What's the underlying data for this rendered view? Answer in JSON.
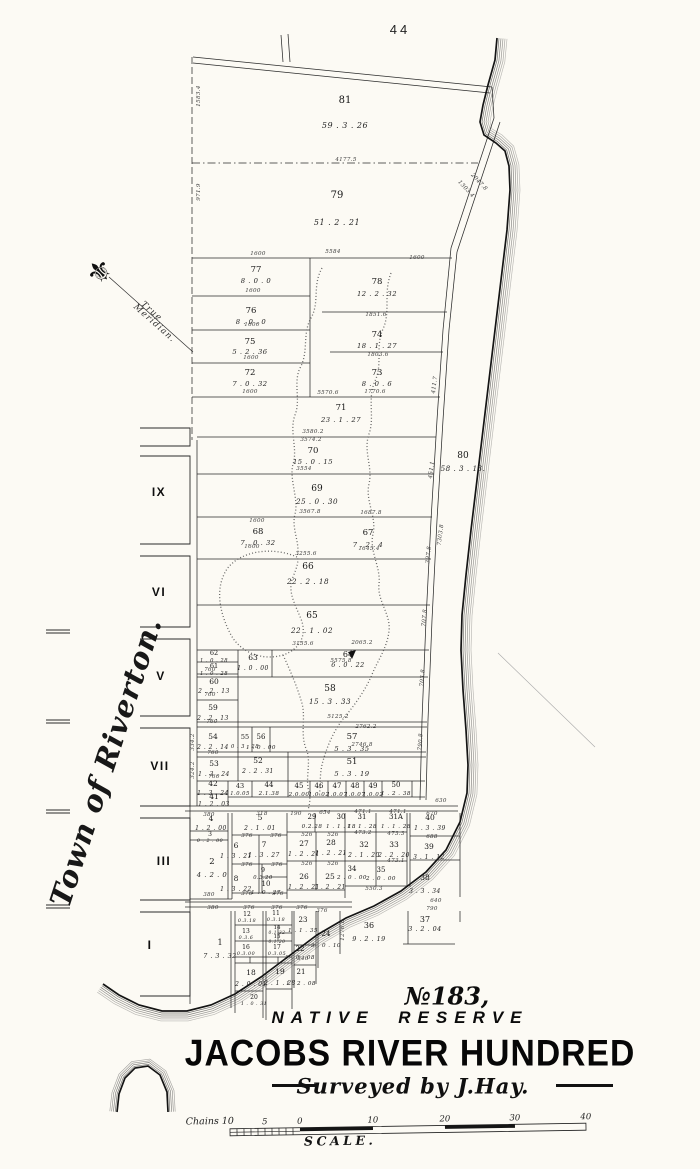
{
  "page": {
    "sheet_number": "44"
  },
  "map": {
    "side_label": "Town of Riverton.",
    "compass_icon": "⚜",
    "compass_label_line1": "True",
    "compass_label_line2": "Meridian.",
    "blocks": [
      {
        "numeral": "IX",
        "x": 159,
        "y": 496
      },
      {
        "numeral": "VI",
        "x": 159,
        "y": 596
      },
      {
        "numeral": "V",
        "x": 161,
        "y": 680
      },
      {
        "numeral": "VII",
        "x": 160,
        "y": 770
      },
      {
        "numeral": "III",
        "x": 164,
        "y": 865
      },
      {
        "numeral": "I",
        "x": 150,
        "y": 949
      }
    ],
    "lots": [
      {
        "n": "81",
        "a": "59 . 3 . 26",
        "x": 345,
        "y": 103,
        "fs": 10,
        "dy": 25
      },
      {
        "n": "79",
        "a": "51 . 2 . 21",
        "x": 337,
        "y": 198,
        "fs": 10,
        "dy": 27
      },
      {
        "n": "77",
        "a": "8 . 0 . 0",
        "x": 256,
        "y": 272,
        "fs": 8.5,
        "dy": 11
      },
      {
        "n": "78",
        "a": "12 . 2 . 32",
        "x": 377,
        "y": 284,
        "fs": 8.5,
        "dy": 12
      },
      {
        "n": "76",
        "a": "8 . 0 . 0",
        "x": 251,
        "y": 313,
        "fs": 8.5,
        "dy": 11
      },
      {
        "n": "74",
        "a": "18 . 1 . 27",
        "x": 377,
        "y": 337,
        "fs": 8.5,
        "dy": 11
      },
      {
        "n": "75",
        "a": "5 . 2 . 36",
        "x": 250,
        "y": 344,
        "fs": 8.5,
        "dy": 10
      },
      {
        "n": "72",
        "a": "7 . 0 . 32",
        "x": 250,
        "y": 375,
        "fs": 8.5,
        "dy": 11
      },
      {
        "n": "73",
        "a": "8 . 0 . 6",
        "x": 377,
        "y": 375,
        "fs": 8.5,
        "dy": 11
      },
      {
        "n": "71",
        "a": "23 . 1 . 27",
        "x": 341,
        "y": 410,
        "fs": 8.5,
        "dy": 12
      },
      {
        "n": "70",
        "a": "15 . 0 . 15",
        "x": 313,
        "y": 453,
        "fs": 8.5,
        "dy": 11
      },
      {
        "n": "69",
        "a": "25 . 0 . 30",
        "x": 317,
        "y": 491,
        "fs": 9,
        "dy": 13
      },
      {
        "n": "80",
        "a": "58 . 3 . 13.",
        "x": 463,
        "y": 458,
        "fs": 9,
        "dy": 13
      },
      {
        "n": "68",
        "a": "7 . 0 . 32",
        "x": 258,
        "y": 534,
        "fs": 8.5,
        "dy": 11
      },
      {
        "n": "67",
        "a": "7 . 2 . 4",
        "x": 368,
        "y": 535,
        "fs": 8.5,
        "dy": 12
      },
      {
        "n": "66",
        "a": "22 . 2 . 18",
        "x": 308,
        "y": 569,
        "fs": 9,
        "dy": 15
      },
      {
        "n": "65",
        "a": "22 . 1 . 02",
        "x": 312,
        "y": 618,
        "fs": 9,
        "dy": 15
      },
      {
        "n": "63",
        "a": "1 . 0 . 00",
        "x": 253,
        "y": 660,
        "fs": 7.5,
        "dy": 10
      },
      {
        "n": "64",
        "a": "6 . 0 . 22",
        "x": 348,
        "y": 657,
        "fs": 8,
        "dy": 10
      },
      {
        "n": "62",
        "a": "1 . 0 . 28",
        "x": 214,
        "y": 655,
        "fs": 6.5,
        "dy": 7
      },
      {
        "n": "61",
        "a": "1 . 0 . 28",
        "x": 214,
        "y": 668,
        "fs": 6.5,
        "dy": 7
      },
      {
        "n": "60",
        "a": "2 . 2 . 13",
        "x": 214,
        "y": 684,
        "fs": 7.5,
        "dy": 9
      },
      {
        "n": "58",
        "a": "15 . 3 . 33",
        "x": 330,
        "y": 691,
        "fs": 9,
        "dy": 13
      },
      {
        "n": "59",
        "a": "2 . 2 . 13",
        "x": 213,
        "y": 710,
        "fs": 7.5,
        "dy": 10
      },
      {
        "n": "54",
        "a": "2 . 2 . 14",
        "x": 213,
        "y": 739,
        "fs": 7.5,
        "dy": 10
      },
      {
        "n": "55",
        "a": "0 . 3 . 28",
        "x": 245,
        "y": 739,
        "fs": 6.5,
        "dy": 9
      },
      {
        "n": "56",
        "a": "1 . 0 . 00",
        "x": 261,
        "y": 739,
        "fs": 7,
        "dy": 10
      },
      {
        "n": "57",
        "a": "5 . 3 . 35",
        "x": 352,
        "y": 739,
        "fs": 8.5,
        "dy": 12
      },
      {
        "n": "53",
        "a": "1 . 3 . 24",
        "x": 214,
        "y": 766,
        "fs": 7.5,
        "dy": 10
      },
      {
        "n": "52",
        "a": "2 . 2 . 31",
        "x": 258,
        "y": 763,
        "fs": 7.5,
        "dy": 10
      },
      {
        "n": "51",
        "a": "5 . 3 . 19",
        "x": 352,
        "y": 764,
        "fs": 8.5,
        "dy": 12
      },
      {
        "n": "42",
        "a": "1 . 3 . 24",
        "x": 213,
        "y": 786,
        "fs": 7.5,
        "dy": 9
      },
      {
        "n": "41",
        "a": "1 . 2 . 03",
        "x": 214,
        "y": 799,
        "fs": 7.5,
        "dy": 7
      },
      {
        "n": "43",
        "a": "1.0.05",
        "x": 240,
        "y": 788,
        "fs": 6.5,
        "dy": 7
      },
      {
        "n": "44",
        "a": "2.1.38",
        "x": 269,
        "y": 787,
        "fs": 7,
        "dy": 8
      },
      {
        "n": "45",
        "a": "2.0.00",
        "x": 299,
        "y": 788,
        "fs": 7,
        "dy": 8
      },
      {
        "n": "46",
        "a": "1.0.02",
        "x": 319,
        "y": 788,
        "fs": 7,
        "dy": 8
      },
      {
        "n": "47",
        "a": "1.0.07",
        "x": 337,
        "y": 788,
        "fs": 7,
        "dy": 8
      },
      {
        "n": "48",
        "a": "1.0.07",
        "x": 355,
        "y": 788,
        "fs": 7,
        "dy": 8
      },
      {
        "n": "49",
        "a": "1.0.02",
        "x": 373,
        "y": 788,
        "fs": 7,
        "dy": 8
      },
      {
        "n": "50",
        "a": "1 . 2 . 38",
        "x": 396,
        "y": 787,
        "fs": 7,
        "dy": 8
      },
      {
        "n": "4",
        "a": "1 . 2 . 00",
        "x": 211,
        "y": 821,
        "fs": 7.5,
        "dy": 9
      },
      {
        "n": "3",
        "a": "0 . 2 . 00",
        "x": 210,
        "y": 836,
        "fs": 6,
        "dy": 6
      },
      {
        "n": "2",
        "a": "4 . 2 . 0",
        "x": 212,
        "y": 864,
        "fs": 8.5,
        "dy": 13
      },
      {
        "n": "5",
        "a": "2 . 1 . 01",
        "x": 260,
        "y": 820,
        "fs": 7.5,
        "dy": 10
      },
      {
        "n": "29",
        "a": "0.2.28",
        "x": 312,
        "y": 819,
        "fs": 7,
        "dy": 9
      },
      {
        "n": "30",
        "a": "1 . 1 . 18",
        "x": 341,
        "y": 819,
        "fs": 7,
        "dy": 9
      },
      {
        "n": "31",
        "a": "1 . 1 . 28",
        "x": 362,
        "y": 819,
        "fs": 7,
        "dy": 9
      },
      {
        "n": "31A",
        "a": "1 . 1 . 28",
        "x": 396,
        "y": 819,
        "fs": 7,
        "dy": 9
      },
      {
        "n": "40",
        "a": "1 . 3 . 39",
        "x": 430,
        "y": 820,
        "fs": 7.5,
        "dy": 10
      },
      {
        "n": "6",
        "a": "1 . 3 . 21",
        "x": 236,
        "y": 848,
        "fs": 7.5,
        "dy": 10
      },
      {
        "n": "7",
        "a": "1 . 3 . 27",
        "x": 264,
        "y": 847,
        "fs": 7.5,
        "dy": 10
      },
      {
        "n": "27",
        "a": "1 . 2 . 21",
        "x": 304,
        "y": 846,
        "fs": 7.5,
        "dy": 10
      },
      {
        "n": "28",
        "a": "1 . 2 . 21",
        "x": 331,
        "y": 845,
        "fs": 7.5,
        "dy": 10
      },
      {
        "n": "32",
        "a": "2 . 1 . 20",
        "x": 364,
        "y": 847,
        "fs": 7.5,
        "dy": 10
      },
      {
        "n": "33",
        "a": "2 . 2 . 20",
        "x": 394,
        "y": 847,
        "fs": 7.5,
        "dy": 10
      },
      {
        "n": "39",
        "a": "3 . 1 . 12",
        "x": 429,
        "y": 849,
        "fs": 7.5,
        "dy": 10
      },
      {
        "n": "8",
        "a": "1 . 3 . 22",
        "x": 236,
        "y": 881,
        "fs": 7.5,
        "dy": 10
      },
      {
        "n": "9",
        "a": "0.3.20",
        "x": 263,
        "y": 872,
        "fs": 6.5,
        "dy": 7
      },
      {
        "n": "10",
        "a": "1 . 0 . 27",
        "x": 266,
        "y": 886,
        "fs": 7,
        "dy": 8
      },
      {
        "n": "26",
        "a": "1 . 2 . 21",
        "x": 304,
        "y": 879,
        "fs": 7.5,
        "dy": 10
      },
      {
        "n": "25",
        "a": "1 . 2 . 21",
        "x": 330,
        "y": 879,
        "fs": 7.5,
        "dy": 10
      },
      {
        "n": "34",
        "a": "2 . 0 . 00",
        "x": 352,
        "y": 871,
        "fs": 7,
        "dy": 8
      },
      {
        "n": "35",
        "a": "2 . 0 . 00",
        "x": 381,
        "y": 872,
        "fs": 7,
        "dy": 8
      },
      {
        "n": "38",
        "a": "3 . 3 . 34",
        "x": 425,
        "y": 880,
        "fs": 7.5,
        "dy": 13
      },
      {
        "n": "1",
        "a": "7 . 3 . 32",
        "x": 220,
        "y": 945,
        "fs": 8,
        "dy": 13
      },
      {
        "n": "12",
        "a": "0.3.18",
        "x": 247,
        "y": 916,
        "fs": 6,
        "dy": 6
      },
      {
        "n": "11",
        "a": "0.3.18",
        "x": 276,
        "y": 915,
        "fs": 6,
        "dy": 6
      },
      {
        "n": "13",
        "a": "0.3.6",
        "x": 246,
        "y": 933,
        "fs": 6,
        "dy": 6
      },
      {
        "n": "14",
        "a": "0.1.32",
        "x": 277,
        "y": 929,
        "fs": 5.5,
        "dy": 5
      },
      {
        "n": "15",
        "a": "0.1.20",
        "x": 277,
        "y": 938,
        "fs": 5.5,
        "dy": 5
      },
      {
        "n": "16",
        "a": "0.3.00",
        "x": 246,
        "y": 949,
        "fs": 6,
        "dy": 6
      },
      {
        "n": "17",
        "a": "0.3.05",
        "x": 277,
        "y": 949,
        "fs": 6,
        "dy": 6
      },
      {
        "n": "23",
        "a": "1 . 1 . 35",
        "x": 303,
        "y": 922,
        "fs": 7,
        "dy": 10
      },
      {
        "n": "22",
        "a": "1 . 0 . 08",
        "x": 300,
        "y": 951,
        "fs": 7,
        "dy": 8
      },
      {
        "n": "24",
        "a": "3 . 0 . 10",
        "x": 326,
        "y": 936,
        "fs": 7,
        "dy": 11
      },
      {
        "n": "36",
        "a": "9 . 2 . 19",
        "x": 369,
        "y": 928,
        "fs": 8,
        "dy": 13
      },
      {
        "n": "37",
        "a": "3 . 2 . 04",
        "x": 425,
        "y": 922,
        "fs": 8,
        "dy": 9
      },
      {
        "n": "18",
        "a": "2 . 0 . 01",
        "x": 251,
        "y": 975,
        "fs": 7.5,
        "dy": 11
      },
      {
        "n": "19",
        "a": "2 . 1 . 28",
        "x": 280,
        "y": 974,
        "fs": 7.5,
        "dy": 11
      },
      {
        "n": "21",
        "a": "1 . 2 . 08",
        "x": 301,
        "y": 974,
        "fs": 7,
        "dy": 11
      },
      {
        "n": "20",
        "a": "1 . 0 . 31",
        "x": 254,
        "y": 999,
        "fs": 6,
        "dy": 6
      }
    ],
    "edge_labels": [
      {
        "t": "4177.5",
        "x": 346,
        "y": 161
      },
      {
        "t": "1600",
        "x": 258,
        "y": 255
      },
      {
        "t": "5584",
        "x": 333,
        "y": 253
      },
      {
        "t": "1600",
        "x": 417,
        "y": 259
      },
      {
        "t": "1600",
        "x": 253,
        "y": 292
      },
      {
        "t": "1600",
        "x": 252,
        "y": 326
      },
      {
        "t": "1600",
        "x": 251,
        "y": 359
      },
      {
        "t": "1600",
        "x": 250,
        "y": 393
      },
      {
        "t": "1851.6",
        "x": 376,
        "y": 316
      },
      {
        "t": "1803.6",
        "x": 378,
        "y": 356
      },
      {
        "t": "1770.6",
        "x": 375,
        "y": 393
      },
      {
        "t": "5570.6",
        "x": 328,
        "y": 394
      },
      {
        "t": "3580.2",
        "x": 313,
        "y": 433
      },
      {
        "t": "3574.2",
        "x": 311,
        "y": 441
      },
      {
        "t": "3554",
        "x": 304,
        "y": 470
      },
      {
        "t": "3567.8",
        "x": 310,
        "y": 513
      },
      {
        "t": "1687.8",
        "x": 371,
        "y": 514
      },
      {
        "t": "1600",
        "x": 257,
        "y": 522
      },
      {
        "t": "1600",
        "x": 252,
        "y": 548
      },
      {
        "t": "1645.4",
        "x": 369,
        "y": 550
      },
      {
        "t": "3255.6",
        "x": 306,
        "y": 555
      },
      {
        "t": "3155.6",
        "x": 303,
        "y": 645
      },
      {
        "t": "2065.2",
        "x": 362,
        "y": 644
      },
      {
        "t": "5575.8",
        "x": 341,
        "y": 662
      },
      {
        "t": "5125.2",
        "x": 338,
        "y": 718
      },
      {
        "t": "2762.2",
        "x": 366,
        "y": 728
      },
      {
        "t": "2746.8",
        "x": 362,
        "y": 746
      },
      {
        "t": "760",
        "x": 210,
        "y": 671
      },
      {
        "t": "760",
        "x": 210,
        "y": 696
      },
      {
        "t": "760",
        "x": 212,
        "y": 723
      },
      {
        "t": "760",
        "x": 213,
        "y": 754
      },
      {
        "t": "760",
        "x": 214,
        "y": 778
      },
      {
        "t": "630",
        "x": 441,
        "y": 802
      },
      {
        "t": "380",
        "x": 209,
        "y": 816
      },
      {
        "t": "318",
        "x": 262,
        "y": 815
      },
      {
        "t": "190",
        "x": 296,
        "y": 815
      },
      {
        "t": "654",
        "x": 325,
        "y": 814
      },
      {
        "t": "471.1",
        "x": 363,
        "y": 813
      },
      {
        "t": "471.1",
        "x": 398,
        "y": 813
      },
      {
        "t": "670",
        "x": 432,
        "y": 815
      },
      {
        "t": "376",
        "x": 247,
        "y": 837
      },
      {
        "t": "376",
        "x": 276,
        "y": 837
      },
      {
        "t": "526",
        "x": 307,
        "y": 836
      },
      {
        "t": "526",
        "x": 333,
        "y": 836
      },
      {
        "t": "473.2",
        "x": 363,
        "y": 834
      },
      {
        "t": "473.3",
        "x": 396,
        "y": 835
      },
      {
        "t": "688",
        "x": 432,
        "y": 838
      },
      {
        "t": "376",
        "x": 247,
        "y": 866
      },
      {
        "t": "376",
        "x": 277,
        "y": 866
      },
      {
        "t": "526",
        "x": 307,
        "y": 865
      },
      {
        "t": "526",
        "x": 333,
        "y": 865
      },
      {
        "t": "473.1",
        "x": 396,
        "y": 862
      },
      {
        "t": "550.3",
        "x": 374,
        "y": 890
      },
      {
        "t": "376",
        "x": 247,
        "y": 895
      },
      {
        "t": "376",
        "x": 278,
        "y": 895
      },
      {
        "t": "380",
        "x": 209,
        "y": 896
      },
      {
        "t": "640",
        "x": 436,
        "y": 902
      },
      {
        "t": "790",
        "x": 432,
        "y": 910
      },
      {
        "t": "380",
        "x": 213,
        "y": 909
      },
      {
        "t": "376",
        "x": 249,
        "y": 909
      },
      {
        "t": "376",
        "x": 277,
        "y": 909
      },
      {
        "t": "376",
        "x": 302,
        "y": 909
      },
      {
        "t": "376",
        "x": 322,
        "y": 912
      },
      {
        "t": "346",
        "x": 303,
        "y": 960
      },
      {
        "t": "1583.4",
        "x": 200,
        "y": 96,
        "r": -90
      },
      {
        "t": "971.9",
        "x": 200,
        "y": 192,
        "r": -90
      },
      {
        "t": "411.7",
        "x": 436,
        "y": 385,
        "r": -83
      },
      {
        "t": "451.1",
        "x": 433,
        "y": 470,
        "r": -83
      },
      {
        "t": "397.8",
        "x": 430,
        "y": 555,
        "r": -84
      },
      {
        "t": "707.8",
        "x": 426,
        "y": 618,
        "r": -85
      },
      {
        "t": "703.8",
        "x": 424,
        "y": 678,
        "r": -86
      },
      {
        "t": "790.8",
        "x": 422,
        "y": 742,
        "r": -87
      },
      {
        "t": "7303.8",
        "x": 442,
        "y": 535,
        "r": -83
      },
      {
        "t": "1303.4",
        "x": 465,
        "y": 190,
        "r": 47
      },
      {
        "t": "2047.8",
        "x": 478,
        "y": 183,
        "r": 47
      },
      {
        "t": "1276.8",
        "x": 344,
        "y": 930,
        "r": -90
      },
      {
        "t": "334.2",
        "x": 194,
        "y": 742,
        "r": -90
      },
      {
        "t": "324.2",
        "x": 194,
        "y": 770,
        "r": -90
      }
    ]
  },
  "title_block": {
    "reserve_number": "№183,",
    "reserve_type": "NATIVE RESERVE",
    "district": "JACOBS RIVER HUNDRED",
    "surveyor_credit": "Surveyed by J.Hay."
  },
  "scale_bar": {
    "unit_label": "Chains 10",
    "ticks": [
      {
        "t": "5",
        "x": 265
      },
      {
        "t": "0",
        "x": 300
      },
      {
        "t": "10",
        "x": 373
      },
      {
        "t": "20",
        "x": 445
      },
      {
        "t": "30",
        "x": 515
      },
      {
        "t": "40",
        "x": 586
      }
    ],
    "caption": "SCALE."
  }
}
